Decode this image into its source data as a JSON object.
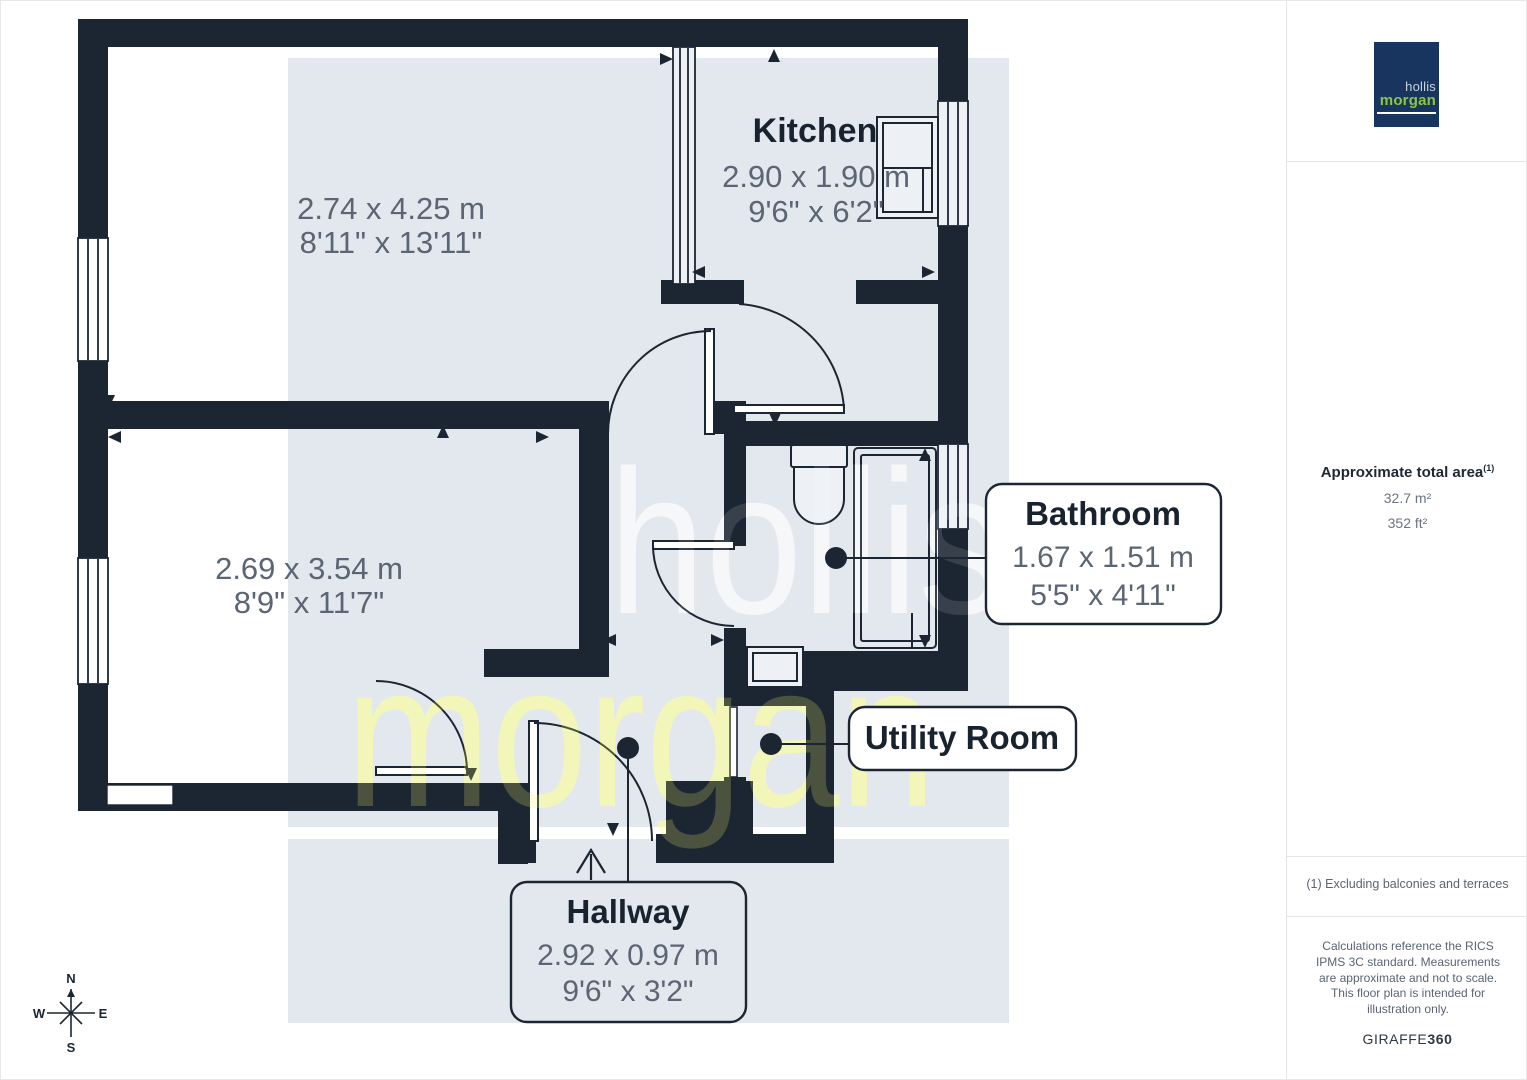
{
  "plan": {
    "room1": {
      "dims_m": "2.74 x 4.25 m",
      "dims_ft": "8'11\" x 13'11\""
    },
    "kitchen": {
      "name": "Kitchen",
      "dims_m": "2.90 x 1.90 m",
      "dims_ft": "9'6\" x 6'2\""
    },
    "room2": {
      "dims_m": "2.69 x 3.54 m",
      "dims_ft": "8'9\" x 11'7\""
    },
    "bathroom": {
      "name": "Bathroom",
      "dims_m": "1.67 x 1.51 m",
      "dims_ft": "5'5\" x 4'11\""
    },
    "utility": {
      "name": "Utility Room"
    },
    "hallway": {
      "name": "Hallway",
      "dims_m": "2.92 x 0.97 m",
      "dims_ft": "9'6\" x 3'2\""
    },
    "compass": {
      "n": "N",
      "e": "E",
      "s": "S",
      "w": "W"
    },
    "watermark": {
      "line1": "hollis",
      "line2": "morgan"
    }
  },
  "sidebar": {
    "logo": {
      "line1": "hollis",
      "line2": "morgan"
    },
    "area": {
      "title": "Approximate total area",
      "note_ref": "(1)",
      "m2": "32.7 m²",
      "ft2": "352 ft²"
    },
    "footnote": "(1) Excluding balconies and terraces",
    "disclaimer": "Calculations reference the RICS IPMS 3C standard. Measurements are approximate and not to scale. This floor plan is intended for illustration only.",
    "brand": {
      "name": "GIRAFFE",
      "suffix": "360"
    }
  },
  "colors": {
    "wall": "#1C2633",
    "band": "#E3E8EE",
    "dim_text": "#5B6574",
    "logo_navy": "#17355E",
    "logo_green": "#8DC63F"
  }
}
